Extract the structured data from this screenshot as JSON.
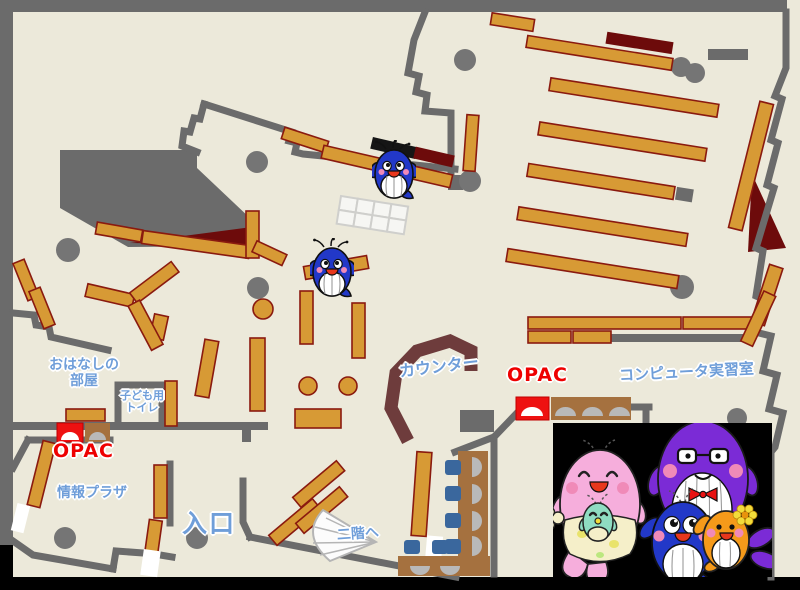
{
  "map": {
    "labels": {
      "storytelling_room": {
        "line1": "おはなしの",
        "line2": "部屋"
      },
      "kids_toilet": {
        "line1": "子ども用",
        "line2": "トイレ"
      },
      "opac_left": "OPAC",
      "opac_right": "OPAC",
      "info_plaza": "情報プラザ",
      "entrance": "入口",
      "to_second_floor": "二階へ",
      "counter": "カウンター",
      "computer_room": "コンピュータ実習室"
    },
    "colors": {
      "floor": "#ece9da",
      "wall": "#6b6b6b",
      "pillar": "#757575",
      "shelf": "#d79a35",
      "shelf_border": "#8a1a0f",
      "dark_red": "#6d0b0b",
      "counter": "#6e3c3c",
      "desk": "#a5713f",
      "chair": "#3a679d",
      "seat": "#b9b9b9",
      "table": "#f6f6f3",
      "table_border": "#cfcfcc",
      "stairs": "#fcfcfc",
      "stairs_border": "#b5b5b5",
      "label_blue": "#6f9ed9",
      "label_red": "#ee0000",
      "door": "#ffffff",
      "panel": "#000000",
      "whale_blue": "#2238c8",
      "whale_pink": "#f6aedc",
      "whale_purple": "#7b2bd6",
      "whale_orange": "#f59a1a",
      "whale_teal": "#8fdcc2",
      "belly": "#ffffff",
      "cheek": "#f08ab8",
      "mouth": "#e8371c",
      "cream": "#f5efc9",
      "flower": "#f2dc3a",
      "bow_red": "#e81212",
      "apron_dot_yellow": "#e9e36b",
      "apron_dot_green": "#bbe77f"
    },
    "icons": [
      "whale-marker-icon",
      "stairs-icon",
      "pillar-icon",
      "opac-terminal-icon",
      "reading-seat-icon",
      "chair-icon",
      "bookshelf",
      "counter-desk",
      "pink-whale-mother",
      "baby-whale",
      "purple-whale-father",
      "blue-whale-child",
      "orange-whale-child",
      "water-spout-icon",
      "flower-icon",
      "bowtie-icon",
      "glasses-icon"
    ]
  }
}
